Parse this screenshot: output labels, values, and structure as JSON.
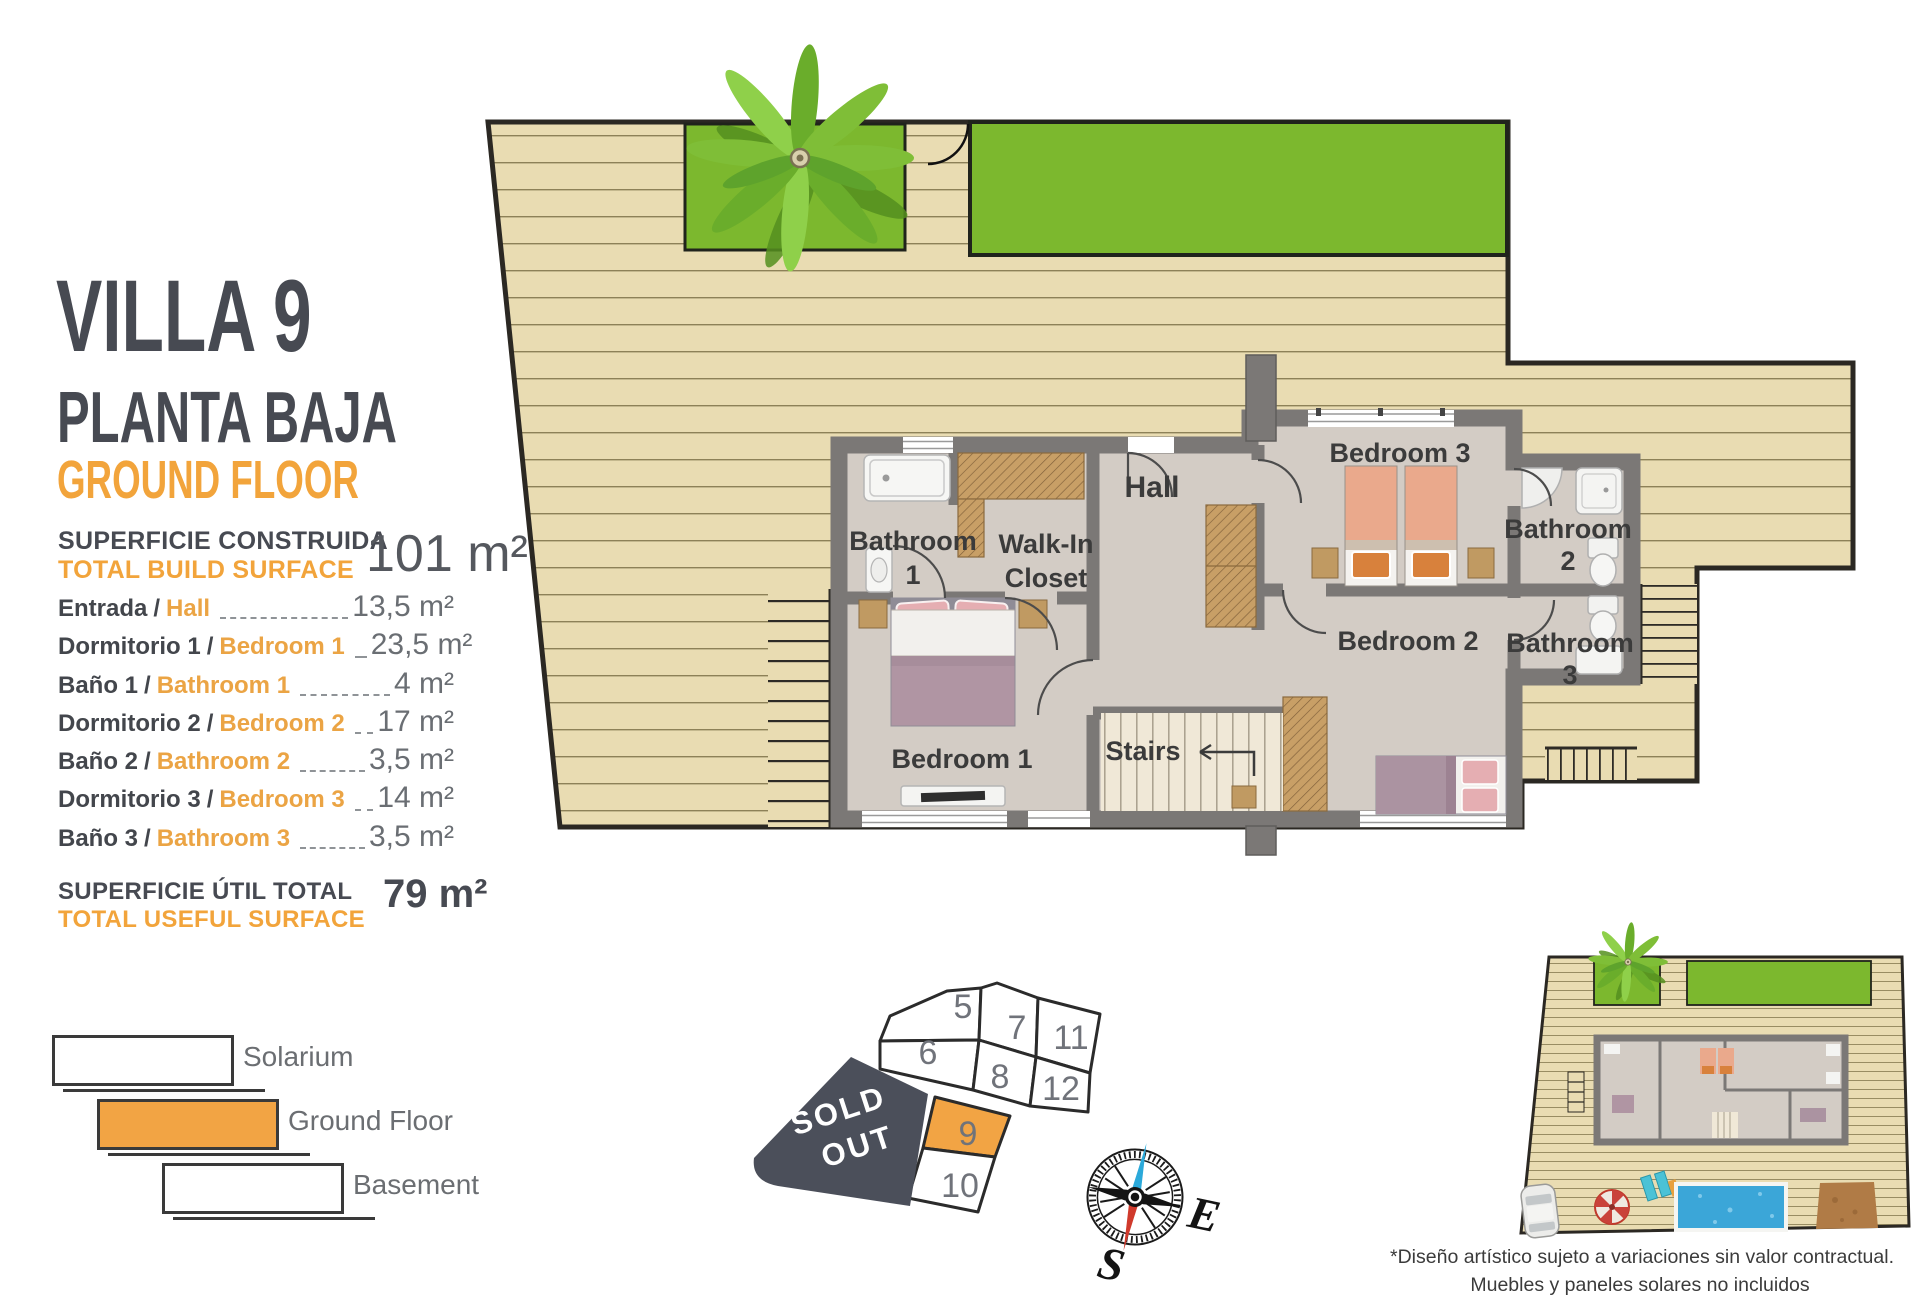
{
  "header": {
    "title": "VILLA 9",
    "subtitle_es": "PLANTA BAJA",
    "subtitle_en": "GROUND FLOOR"
  },
  "build_surface": {
    "label_es": "SUPERFICIE CONSTRUIDA",
    "label_en": "TOTAL BUILD SURFACE",
    "value": "101 m²"
  },
  "separator": "/",
  "rooms": [
    {
      "es": "Entrada",
      "en": "Hall",
      "area": "13,5 m²"
    },
    {
      "es": "Dormitorio 1",
      "en": "Bedroom 1",
      "area": "23,5 m²"
    },
    {
      "es": "Baño 1",
      "en": "Bathroom 1",
      "area": "4 m²"
    },
    {
      "es": "Dormitorio 2",
      "en": "Bedroom 2",
      "area": "17 m²"
    },
    {
      "es": "Baño 2",
      "en": "Bathroom 2",
      "area": "3,5 m²"
    },
    {
      "es": "Dormitorio 3",
      "en": "Bedroom 3",
      "area": "14 m²"
    },
    {
      "es": "Baño 3",
      "en": "Bathroom 3",
      "area": "3,5 m²"
    }
  ],
  "useful_surface": {
    "label_es": "SUPERFICIE ÚTIL TOTAL",
    "label_en": "TOTAL USEFUL SURFACE",
    "value": "79 m²"
  },
  "legend": [
    {
      "label": "Solarium",
      "fill": "#FFFFFF"
    },
    {
      "label": "Ground Floor",
      "fill": "#F2A444"
    },
    {
      "label": "Basement",
      "fill": "#FFFFFF"
    }
  ],
  "floorplan": {
    "labels": {
      "bathroom1": [
        "Bathroom",
        "1"
      ],
      "walk_in_closet": [
        "Walk-In",
        "Closet"
      ],
      "hall": "Hall",
      "bedroom3": "Bedroom 3",
      "bathroom2": [
        "Bathroom",
        "2"
      ],
      "bathroom3": [
        "Bathroom",
        "3"
      ],
      "bedroom2": "Bedroom 2",
      "bedroom1": "Bedroom 1",
      "stairs": "Stairs"
    }
  },
  "site_plan": {
    "plots": [
      "5",
      "7",
      "11",
      "6",
      "8",
      "12",
      "9",
      "10"
    ],
    "sold_out": [
      "SOLD",
      "OUT"
    ],
    "highlighted_plot": "9"
  },
  "compass": {
    "east": "E",
    "south": "S"
  },
  "disclaimer": {
    "line1": "*Diseño artístico sujeto a variaciones sin valor contractual.",
    "line2": "Muebles y paneles solares no incluidos"
  },
  "colors": {
    "accent_orange": "#F2A444",
    "title_gray": "#474A52",
    "sold_out_bg": "#4B4F5A",
    "lawn_green": "#7CB82E",
    "deck_tan": "#E9DCB2",
    "wall_gray": "#7B7876",
    "pool_blue": "#3BA6D8"
  }
}
